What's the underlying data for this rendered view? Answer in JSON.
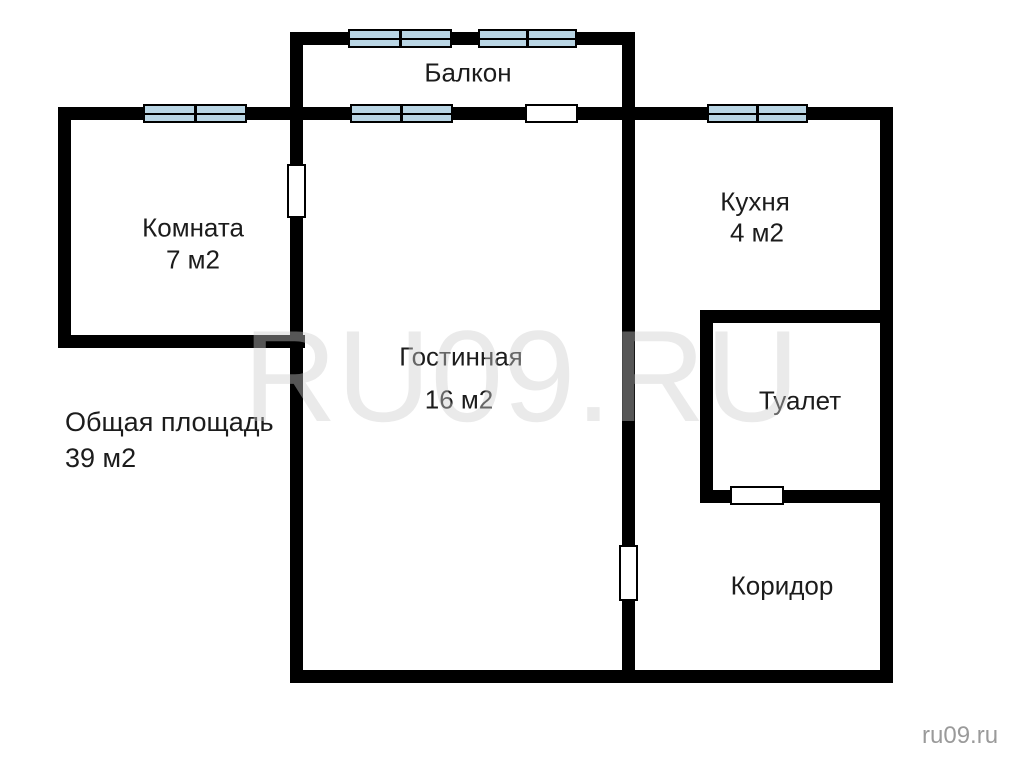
{
  "texts": {
    "watermark": "RU09.RU",
    "site_credit": "ru09.ru",
    "total_area_label": "Общая площадь",
    "total_area_value": "39 м2"
  },
  "colors": {
    "background": "#ffffff",
    "wall_color": "#000000",
    "window_fill": "#b9d5e4",
    "door_fill": "#ffffff",
    "label_color": "#1c1c1c",
    "watermark_color": "rgba(206,206,206,0.42)",
    "credit_color": "#9a9a9a"
  },
  "floor_plan": {
    "rooms": [
      {
        "id": "balcony",
        "label": "Балкон",
        "area": "",
        "label_x": 468,
        "label_y": 73
      },
      {
        "id": "room",
        "label": "Комната",
        "area": "7 м2",
        "label_x": 193,
        "label_y": 228,
        "area_x": 193,
        "area_y": 260
      },
      {
        "id": "living-room",
        "label": "Гостинная",
        "area": "16 м2",
        "label_x": 461,
        "label_y": 357,
        "area_x": 459,
        "area_y": 400
      },
      {
        "id": "kitchen",
        "label": "Кухня",
        "area": "4 м2",
        "label_x": 755,
        "label_y": 202,
        "area_x": 757,
        "area_y": 233
      },
      {
        "id": "toilet",
        "label": "Туалет",
        "area": "",
        "label_x": 800,
        "label_y": 401
      },
      {
        "id": "corridor",
        "label": "Коридор",
        "area": "",
        "label_x": 782,
        "label_y": 586
      }
    ],
    "walls": [
      {
        "id": "balcony-left-wall",
        "x": 290,
        "y": 32,
        "w": 13,
        "h": 88
      },
      {
        "id": "balcony-top-wall",
        "x": 290,
        "y": 32,
        "w": 345,
        "h": 13
      },
      {
        "id": "balcony-right-wall",
        "x": 622,
        "y": 32,
        "w": 13,
        "h": 88
      },
      {
        "id": "top-outer-wall",
        "x": 58,
        "y": 107,
        "w": 835,
        "h": 13
      },
      {
        "id": "left-outer-wall",
        "x": 58,
        "y": 107,
        "w": 13,
        "h": 241
      },
      {
        "id": "room-bottom-wall",
        "x": 58,
        "y": 335,
        "w": 247,
        "h": 13
      },
      {
        "id": "room-living-divider-wall",
        "x": 290,
        "y": 107,
        "w": 13,
        "h": 576
      },
      {
        "id": "living-right-wall",
        "x": 622,
        "y": 107,
        "w": 13,
        "h": 576
      },
      {
        "id": "right-outer-wall",
        "x": 880,
        "y": 107,
        "w": 13,
        "h": 576
      },
      {
        "id": "bottom-outer-wall",
        "x": 290,
        "y": 670,
        "w": 603,
        "h": 13
      },
      {
        "id": "kitchen-bottom-wall",
        "x": 700,
        "y": 310,
        "w": 193,
        "h": 13
      },
      {
        "id": "toilet-left-wall",
        "x": 700,
        "y": 310,
        "w": 13,
        "h": 193
      },
      {
        "id": "toilet-bottom-wall",
        "x": 700,
        "y": 490,
        "w": 193,
        "h": 13
      }
    ],
    "windows": [
      {
        "id": "balcony-window-1",
        "x": 348,
        "y": 29,
        "w": 104,
        "h": 19
      },
      {
        "id": "balcony-window-2",
        "x": 478,
        "y": 29,
        "w": 99,
        "h": 19
      },
      {
        "id": "room-window",
        "x": 143,
        "y": 104,
        "w": 104,
        "h": 19
      },
      {
        "id": "living-room-window",
        "x": 350,
        "y": 104,
        "w": 103,
        "h": 19
      },
      {
        "id": "kitchen-window",
        "x": 707,
        "y": 104,
        "w": 101,
        "h": 19
      }
    ],
    "doors": [
      {
        "id": "balcony-door",
        "x": 525,
        "y": 104,
        "w": 53,
        "h": 19
      },
      {
        "id": "room-door",
        "x": 287,
        "y": 164,
        "w": 19,
        "h": 54
      },
      {
        "id": "living-room-door",
        "x": 619,
        "y": 545,
        "w": 19,
        "h": 56
      },
      {
        "id": "toilet-door",
        "x": 730,
        "y": 486,
        "w": 54,
        "h": 19
      }
    ]
  }
}
